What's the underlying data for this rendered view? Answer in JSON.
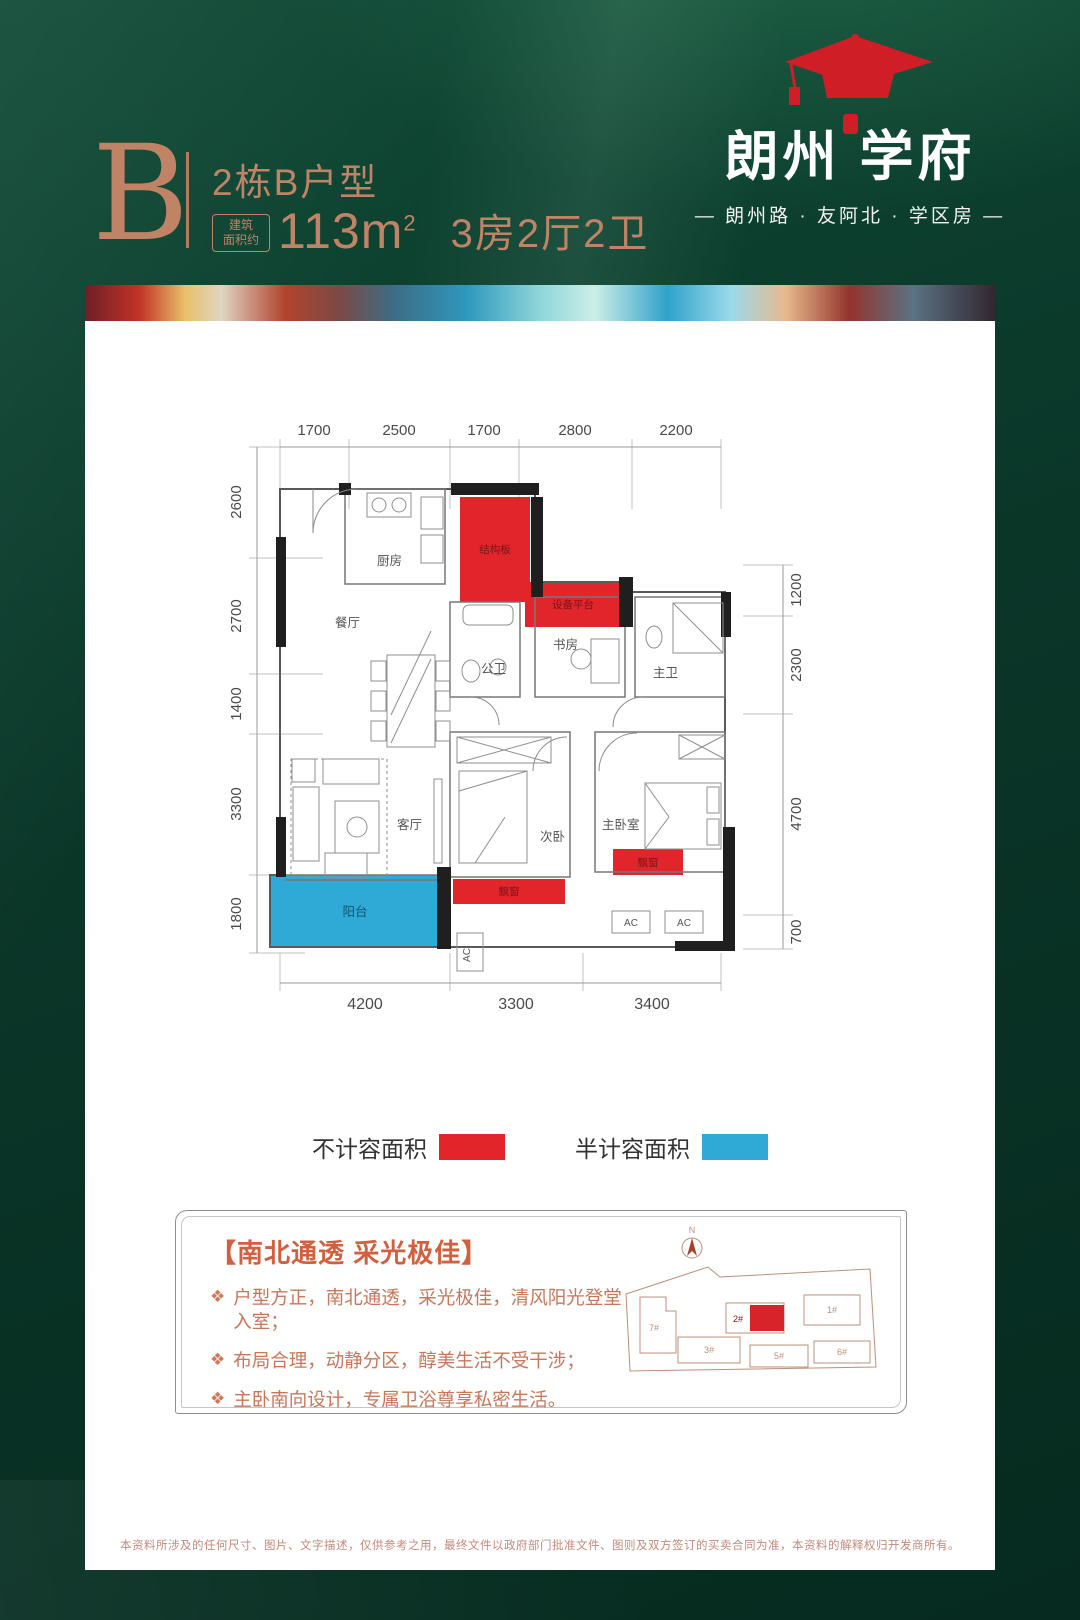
{
  "header": {
    "unit_letter": "B",
    "unit_title": "2栋B户型",
    "area_prefix_line1": "建筑",
    "area_prefix_line2": "面积约",
    "area_value": "113m",
    "area_sup": "2",
    "rooms_text": "3房2厅2卫"
  },
  "logo": {
    "name_left": "朗州",
    "name_right": "学府",
    "tagline": "— 朗州路 · 友阿北 · 学区房 —"
  },
  "floorplan": {
    "dims_top": [
      "1700",
      "2500",
      "1700",
      "2800",
      "2200"
    ],
    "dims_left": [
      "2600",
      "2700",
      "1400",
      "3300",
      "1800"
    ],
    "dims_right": [
      "1200",
      "2300",
      "4700",
      "700"
    ],
    "dims_bottom": [
      "4200",
      "3300",
      "3400"
    ],
    "rooms": {
      "kitchen": "厨房",
      "dining": "餐厅",
      "living": "客厅",
      "balcony": "阳台",
      "bedroom2": "次卧",
      "master_bedroom": "主卧室",
      "master_bath": "主卫",
      "public_bath": "公卫",
      "study": "书房",
      "structure_slab": "结构板",
      "equipment_platform": "设备平台",
      "bay_window": "飘窗",
      "ac": "AC"
    },
    "colors": {
      "non_countable_red": "#e2242b",
      "half_countable_blue": "#2fa9d6"
    }
  },
  "legend": {
    "items": [
      {
        "label": "不计容面积",
        "color": "#e2242b"
      },
      {
        "label": "半计容面积",
        "color": "#2fa9d6"
      }
    ]
  },
  "features": {
    "title": "【南北通透 采光极佳】",
    "bullet_icon": "❖",
    "items": [
      "户型方正，南北通透，采光极佳，清风阳光登堂入室；",
      "布局合理，动静分区，醇美生活不受干涉；",
      "主卧南向设计，专属卫浴尊享私密生活。"
    ]
  },
  "sitemap": {
    "north": "N",
    "buildings": [
      "7#",
      "3#",
      "2#",
      "1#",
      "5#",
      "6#"
    ]
  },
  "disclaimer": "本资料所涉及的任何尺寸、图片、文字描述，仅供参考之用，最终文件以政府部门批准文件、图则及双方签订的买卖合同为准，本资料的解释权归开发商所有。"
}
